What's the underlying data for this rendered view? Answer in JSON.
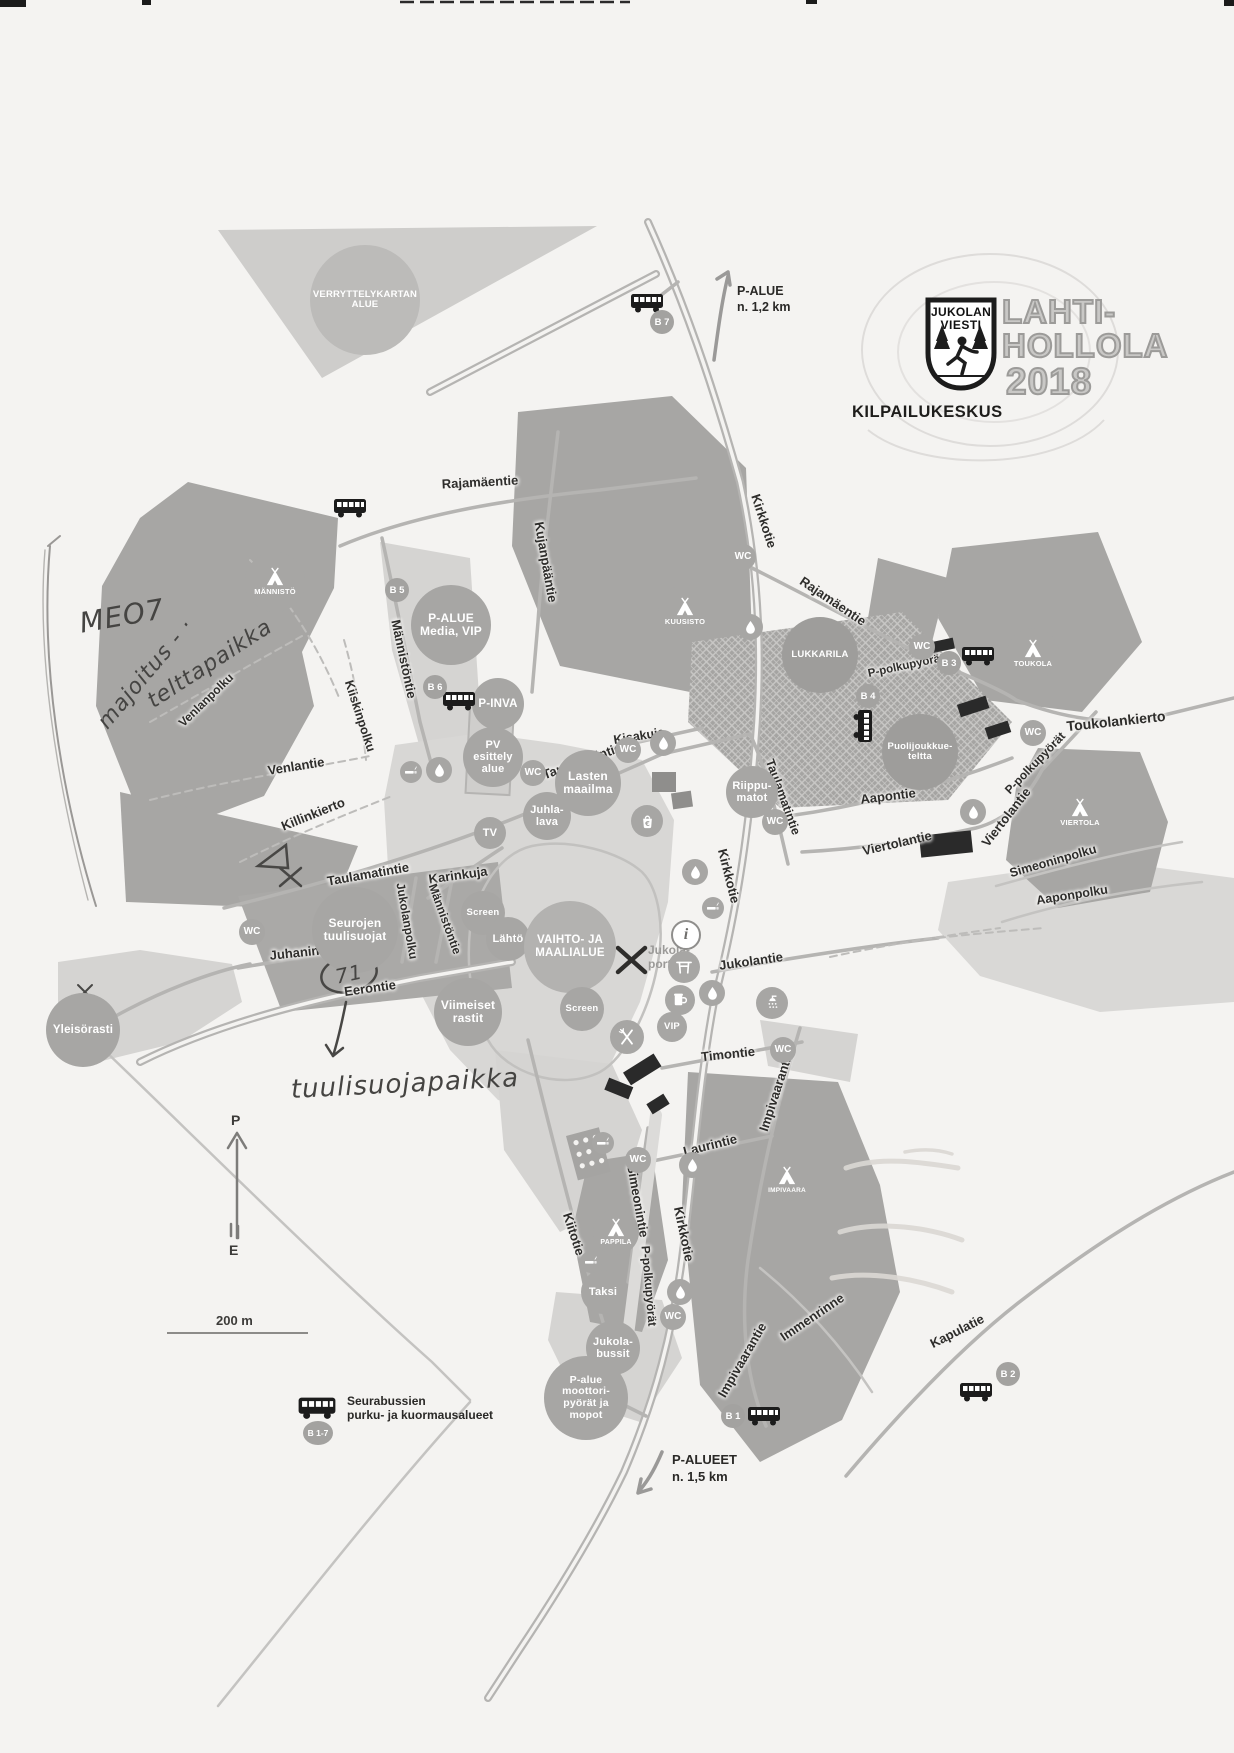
{
  "logo": {
    "shield_line1": "JUKOLAN",
    "shield_line2": "VIESTI",
    "event_line1": "LAHTI-",
    "event_line2": "HOLLOLA",
    "event_year": "2018",
    "subtitle": "KILPAILUKESKUS"
  },
  "colors": {
    "paper": "#f4f3f1",
    "area_gray": "#a7a6a4",
    "light_gray": "#d5d4d2",
    "road_gray": "#b5b4b2",
    "ink": "#2e2d2b"
  },
  "compass": {
    "north": "P",
    "south": "E"
  },
  "scalebar": {
    "label": "200 m"
  },
  "legend": {
    "line1": "Seurabussien",
    "line2": "purku- ja kuormausalueet",
    "badge": "B 1-7"
  },
  "arrows": {
    "top": {
      "line1": "P-ALUE",
      "line2": "n. 1,2 km"
    },
    "bottom": {
      "line1": "P-ALUEET",
      "line2": "n. 1,5 km"
    }
  },
  "portti": {
    "line1": "Jukola-",
    "line2": "portti"
  },
  "strings": {
    "wc": "WC"
  },
  "road_labels": [
    {
      "t": "Rajamäentie",
      "x": 480,
      "y": 482,
      "r": -3
    },
    {
      "t": "Kujanpääntie",
      "x": 546,
      "y": 562,
      "r": 80
    },
    {
      "t": "Kirkkotie",
      "x": 764,
      "y": 521,
      "r": 72
    },
    {
      "t": "Rajamäentie",
      "x": 833,
      "y": 601,
      "r": 34
    },
    {
      "t": "Toukolankierto",
      "x": 1116,
      "y": 721,
      "r": -6,
      "s": 14
    },
    {
      "t": "Männistöntie",
      "x": 404,
      "y": 659,
      "r": 78
    },
    {
      "t": "Venlanpolku",
      "x": 206,
      "y": 700,
      "r": -44,
      "s": 12
    },
    {
      "t": "Venlantie",
      "x": 296,
      "y": 766,
      "r": -9
    },
    {
      "t": "Kiiskinpolku",
      "x": 360,
      "y": 716,
      "r": 72,
      "s": 12.5
    },
    {
      "t": "Killinkierto",
      "x": 313,
      "y": 814,
      "r": -22
    },
    {
      "t": "Taulamatintie",
      "x": 368,
      "y": 874,
      "r": -10
    },
    {
      "t": "Karinkuja",
      "x": 458,
      "y": 875,
      "r": -8
    },
    {
      "t": "Jukolanpolku",
      "x": 407,
      "y": 921,
      "r": 80,
      "s": 12
    },
    {
      "t": "Männistöntie",
      "x": 445,
      "y": 919,
      "r": 70,
      "s": 12
    },
    {
      "t": "Juhanintie",
      "x": 302,
      "y": 952,
      "r": -6
    },
    {
      "t": "Eerontie",
      "x": 370,
      "y": 988,
      "r": -8
    },
    {
      "t": "Taulamatintie",
      "x": 582,
      "y": 761,
      "r": -20
    },
    {
      "t": "Kisakuja",
      "x": 639,
      "y": 736,
      "r": -9,
      "s": 12.5
    },
    {
      "t": "Taulamatintie",
      "x": 783,
      "y": 797,
      "r": 70,
      "s": 12.5
    },
    {
      "t": "Aapontie",
      "x": 888,
      "y": 796,
      "r": -7
    },
    {
      "t": "Viertolantie",
      "x": 897,
      "y": 843,
      "r": -13
    },
    {
      "t": "Viertolantie",
      "x": 1006,
      "y": 817,
      "r": -52
    },
    {
      "t": "P-polkupyörät",
      "x": 1035,
      "y": 763,
      "r": -46,
      "s": 12
    },
    {
      "t": "P-polkupyörät",
      "x": 906,
      "y": 666,
      "r": -12,
      "s": 11.5
    },
    {
      "t": "Simeoninpolku",
      "x": 1053,
      "y": 861,
      "r": -16,
      "s": 12.5
    },
    {
      "t": "Aaponpolku",
      "x": 1072,
      "y": 895,
      "r": -9,
      "s": 12.5
    },
    {
      "t": "Kirkkotie",
      "x": 729,
      "y": 876,
      "r": 76
    },
    {
      "t": "Jukolantie",
      "x": 751,
      "y": 961,
      "r": -8
    },
    {
      "t": "Timontie",
      "x": 728,
      "y": 1054,
      "r": -6
    },
    {
      "t": "Laurintie",
      "x": 710,
      "y": 1145,
      "r": -14
    },
    {
      "t": "Impivaarantie",
      "x": 776,
      "y": 1091,
      "r": -72
    },
    {
      "t": "Simeonintie",
      "x": 638,
      "y": 1201,
      "r": 80
    },
    {
      "t": "Kiitotie",
      "x": 574,
      "y": 1234,
      "r": 72
    },
    {
      "t": "Kirkkotie",
      "x": 684,
      "y": 1234,
      "r": 78
    },
    {
      "t": "P-polkupyörät",
      "x": 649,
      "y": 1286,
      "r": 85,
      "s": 12
    },
    {
      "t": "Impivaarantie",
      "x": 742,
      "y": 1360,
      "r": -60
    },
    {
      "t": "Immenrinne",
      "x": 812,
      "y": 1317,
      "r": -34
    },
    {
      "t": "Kapulatie",
      "x": 957,
      "y": 1331,
      "r": -27
    }
  ],
  "circles": [
    {
      "lines": [
        "MÄNNISTÖ"
      ],
      "x": 275,
      "y": 582,
      "rr": 30,
      "fs": 7.5,
      "tent": true
    },
    {
      "lines": [
        "KUUSISTO"
      ],
      "x": 685,
      "y": 612,
      "rr": 27,
      "fs": 7.5,
      "tent": true
    },
    {
      "lines": [
        "TOUKOLA"
      ],
      "x": 1033,
      "y": 654,
      "rr": 26,
      "fs": 7.5,
      "tent": true
    },
    {
      "lines": [
        "VIERTOLA"
      ],
      "x": 1080,
      "y": 813,
      "rr": 27,
      "fs": 7.5,
      "tent": true
    },
    {
      "lines": [
        "PAPPILA"
      ],
      "x": 616,
      "y": 1232,
      "rr": 23,
      "fs": 7,
      "tent": true
    },
    {
      "lines": [
        "IMPIVAARA"
      ],
      "x": 787,
      "y": 1180,
      "rr": 21,
      "fs": 6.5,
      "tent": true
    },
    {
      "lines": [
        "LUKKARILA"
      ],
      "x": 820,
      "y": 655,
      "rr": 38,
      "fs": 9.5,
      "bg": "#9e9d9b"
    },
    {
      "lines": [
        "Puolijoukkue-",
        "teltta"
      ],
      "x": 920,
      "y": 752,
      "rr": 38,
      "fs": 9.5,
      "bg": "#9e9d9b"
    },
    {
      "lines": [
        "VERRYTTELYKARTAN",
        "ALUE"
      ],
      "x": 365,
      "y": 300,
      "rr": 55,
      "fs": 9.5,
      "bg": "#bcbbb9"
    },
    {
      "lines": [
        "P-ALUE",
        "Media, VIP"
      ],
      "x": 451,
      "y": 625,
      "rr": 40,
      "fs": 12
    },
    {
      "lines": [
        "P-INVA"
      ],
      "x": 498,
      "y": 704,
      "rr": 26,
      "fs": 11.5
    },
    {
      "lines": [
        "PV",
        "esittely",
        "alue"
      ],
      "x": 493,
      "y": 757,
      "rr": 30,
      "fs": 11
    },
    {
      "lines": [
        "Lasten",
        "maailma"
      ],
      "x": 588,
      "y": 783,
      "rr": 33,
      "fs": 12
    },
    {
      "lines": [
        "Juhla-",
        "lava"
      ],
      "x": 547,
      "y": 816,
      "rr": 24,
      "fs": 11
    },
    {
      "lines": [
        "TV"
      ],
      "x": 490,
      "y": 833,
      "rr": 16,
      "fs": 11
    },
    {
      "lines": [
        "Screen"
      ],
      "x": 483,
      "y": 913,
      "rr": 22,
      "fs": 9.5
    },
    {
      "lines": [
        "Lähtö"
      ],
      "x": 508,
      "y": 939,
      "rr": 22,
      "fs": 11
    },
    {
      "lines": [
        "VAIHTO- JA",
        "MAALIALUE"
      ],
      "x": 570,
      "y": 947,
      "rr": 46,
      "fs": 11.5,
      "bg": "#b3b2b0"
    },
    {
      "lines": [
        "Screen"
      ],
      "x": 582,
      "y": 1009,
      "rr": 22,
      "fs": 9.5
    },
    {
      "lines": [
        "Viimeiset",
        "rastit"
      ],
      "x": 468,
      "y": 1012,
      "rr": 34,
      "fs": 12
    },
    {
      "lines": [
        "Seurojen",
        "tuulisuojat"
      ],
      "x": 355,
      "y": 930,
      "rr": 43,
      "fs": 12
    },
    {
      "lines": [
        "Yleisörasti"
      ],
      "x": 83,
      "y": 1030,
      "rr": 37,
      "fs": 11.5
    },
    {
      "lines": [
        "Riippu-",
        "matot"
      ],
      "x": 752,
      "y": 792,
      "rr": 26,
      "fs": 11
    },
    {
      "lines": [
        "VIP"
      ],
      "x": 672,
      "y": 1027,
      "rr": 15,
      "fs": 9.5
    },
    {
      "lines": [
        "Taksi"
      ],
      "x": 603,
      "y": 1292,
      "rr": 22,
      "fs": 11
    },
    {
      "lines": [
        "Jukola-",
        "bussit"
      ],
      "x": 613,
      "y": 1348,
      "rr": 27,
      "fs": 11
    },
    {
      "lines": [
        "P-alue",
        "moottori-",
        "pyörät ja",
        "mopot"
      ],
      "x": 586,
      "y": 1398,
      "rr": 42,
      "fs": 10.5
    }
  ],
  "icons": [
    {
      "t": "wc",
      "x": 743,
      "y": 557
    },
    {
      "t": "wc",
      "x": 922,
      "y": 647
    },
    {
      "t": "wc",
      "x": 1033,
      "y": 733
    },
    {
      "t": "wc",
      "x": 533,
      "y": 773
    },
    {
      "t": "wc",
      "x": 628,
      "y": 750
    },
    {
      "t": "wc",
      "x": 252,
      "y": 932
    },
    {
      "t": "wc",
      "x": 775,
      "y": 822
    },
    {
      "t": "wc",
      "x": 783,
      "y": 1050
    },
    {
      "t": "wc",
      "x": 638,
      "y": 1160
    },
    {
      "t": "wc",
      "x": 673,
      "y": 1317
    },
    {
      "t": "drop",
      "x": 439,
      "y": 770
    },
    {
      "t": "drop",
      "x": 663,
      "y": 743
    },
    {
      "t": "drop",
      "x": 750,
      "y": 627
    },
    {
      "t": "drop",
      "x": 973,
      "y": 812
    },
    {
      "t": "drop",
      "x": 695,
      "y": 872
    },
    {
      "t": "drop",
      "x": 712,
      "y": 993
    },
    {
      "t": "drop",
      "x": 692,
      "y": 1165
    },
    {
      "t": "drop",
      "x": 680,
      "y": 1292
    },
    {
      "t": "smoke",
      "x": 411,
      "y": 772
    },
    {
      "t": "smoke",
      "x": 713,
      "y": 908
    },
    {
      "t": "smoke",
      "x": 603,
      "y": 1143
    },
    {
      "t": "smoke",
      "x": 591,
      "y": 1262
    },
    {
      "t": "shower",
      "x": 772,
      "y": 1003
    },
    {
      "t": "info",
      "x": 684,
      "y": 933
    },
    {
      "t": "gate",
      "x": 684,
      "y": 967
    },
    {
      "t": "beer",
      "x": 680,
      "y": 1000
    },
    {
      "t": "food",
      "x": 627,
      "y": 1037
    },
    {
      "t": "shop",
      "x": 647,
      "y": 821
    }
  ],
  "bus_stops": [
    {
      "badge": "B 7",
      "bx": 662,
      "by": 322,
      "x": 647,
      "y": 303
    },
    {
      "badge": "B 5",
      "bx": 397,
      "by": 590,
      "x": 350,
      "y": 508
    },
    {
      "badge": "B 6",
      "bx": 435,
      "by": 687,
      "x": 459,
      "y": 701
    },
    {
      "badge": "B 3",
      "bx": 949,
      "by": 663,
      "x": 978,
      "y": 656
    },
    {
      "badge": "B 4",
      "bx": 868,
      "by": 696,
      "x": 863,
      "y": 726,
      "vert": true
    },
    {
      "badge": "B 1",
      "bx": 733,
      "by": 1416,
      "x": 764,
      "y": 1416
    },
    {
      "badge": "B 2",
      "bx": 1008,
      "by": 1374,
      "x": 976,
      "y": 1392
    }
  ],
  "handwriting": [
    {
      "t": "MEO7",
      "x": 122,
      "y": 616,
      "r": -10,
      "s": 28
    },
    {
      "t": "majoitus - ·",
      "x": 146,
      "y": 674,
      "r": -50,
      "s": 22
    },
    {
      "t": "telttapaikka",
      "x": 210,
      "y": 664,
      "r": -33,
      "s": 22
    },
    {
      "t": "71",
      "x": 349,
      "y": 974,
      "r": -12,
      "s": 20
    },
    {
      "t": "tuulisuojapaikka",
      "x": 405,
      "y": 1084,
      "r": -3,
      "s": 26
    }
  ]
}
